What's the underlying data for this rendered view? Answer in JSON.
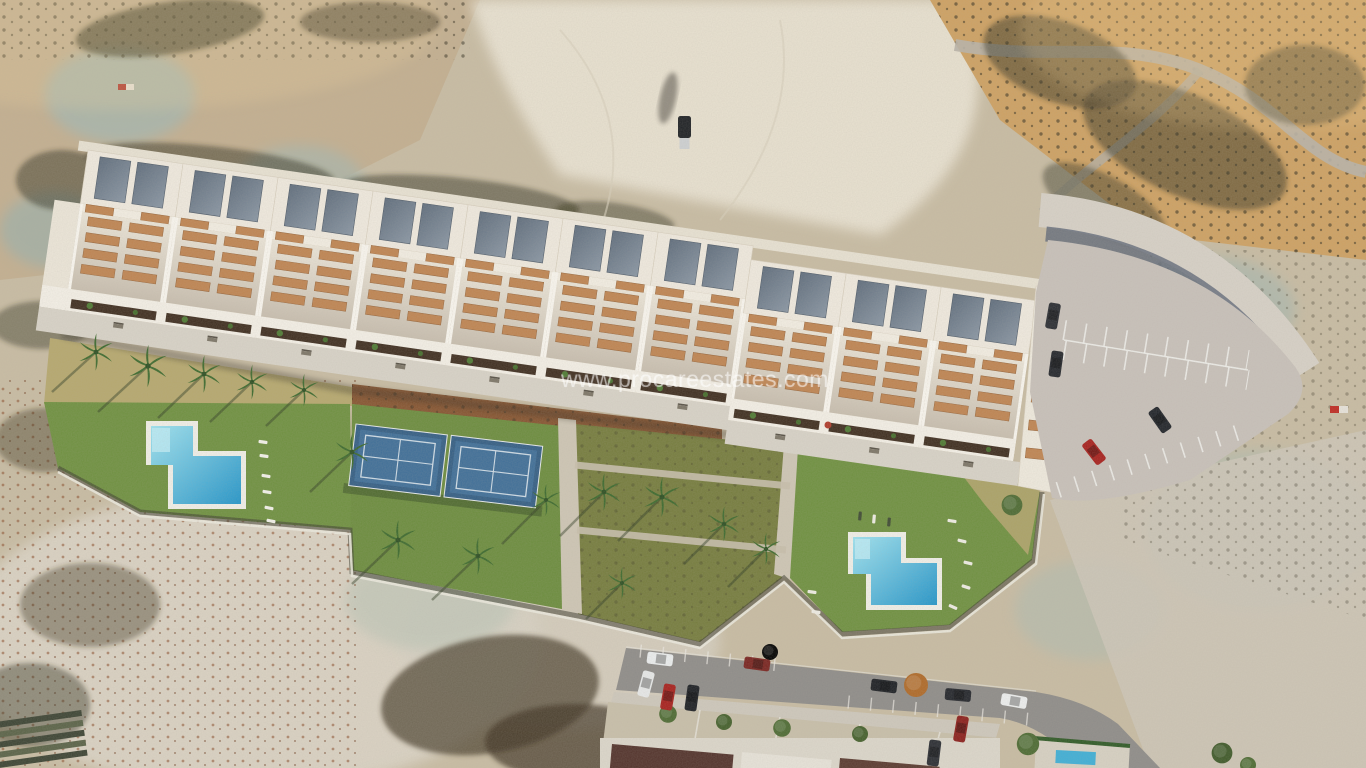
{
  "watermark": {
    "text": "www.procareestates.com"
  },
  "palette": {
    "terrain_tan": "#c9bda4",
    "riverbed_pale": "#e9e2d1",
    "terrain_gold": "#cfa263",
    "terrain_teal": "#a4b8b2",
    "scrub_dark": "#34301f",
    "rust_scrub": "#8a4a28",
    "building_white": "#f1ebe0",
    "roof_panel_blue": "#6b7888",
    "balcony_terracotta": "#c08552",
    "lawn_green": "#6f9140",
    "garden_olive": "#767d3e",
    "mulch_brown": "#875531",
    "pool_water_blue": "#45b8dc",
    "padel_court_blue": "#3f6f99",
    "parking_grey": "#c9c2bb",
    "road_grey": "#8f8d8a",
    "path_beige": "#cfc7b6",
    "roof_maroon": "#53332c",
    "watermark_white": "#ffffff"
  }
}
